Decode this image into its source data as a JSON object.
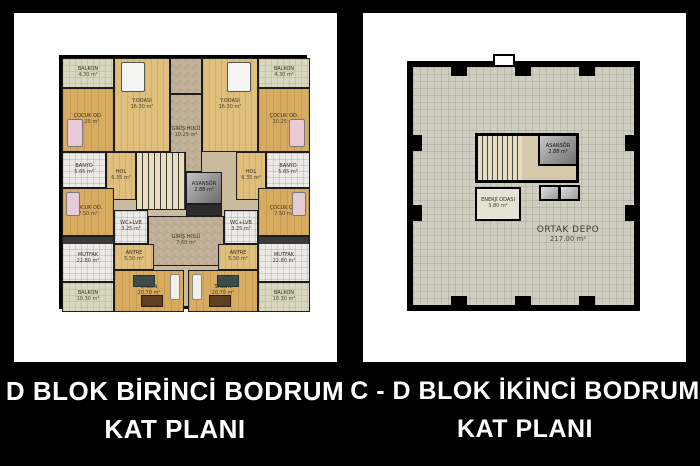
{
  "colors": {
    "background": "#000000",
    "panel": "#ffffff",
    "wood_floor": "#d7ab60",
    "hall_stone": "#c2b198",
    "balcony": "#d9d7bd",
    "depot_floor": "#cecdbf",
    "caption_text": "#ffffff"
  },
  "left_panel": {
    "caption_line1": "D BLOK BİRİNCİ BODRUM",
    "caption_line2": "KAT PLANI",
    "plan": {
      "rooms": {
        "balkon_ust": {
          "name": "BALKON",
          "area": "4.30 m²"
        },
        "cocuk_od_ust": {
          "name": "ÇOCUK OD.",
          "area": "10.25 m²"
        },
        "y_odasi": {
          "name": "Y.ODASI",
          "area": "16.30 m²"
        },
        "giris_holu_ust": {
          "name": "GİRİŞ HOLÜ",
          "area": "10.25 m²"
        },
        "banyo": {
          "name": "BANYO",
          "area": "5.65 m²"
        },
        "hol": {
          "name": "HOL",
          "area": "6.35 m²"
        },
        "asansor": {
          "name": "ASANSÖR",
          "area": "2.88 m²"
        },
        "cocuk_od_alt": {
          "name": "ÇOCUK OD.",
          "area": "7.50 m²"
        },
        "wc_lvb": {
          "name": "WC+LVB",
          "area": "3.25 m²"
        },
        "giris_holu_alt": {
          "name": "GİRİŞ HOLÜ",
          "area": "7.60 m²"
        },
        "antre": {
          "name": "ANTRE",
          "area": "5.50 m²"
        },
        "mutfak": {
          "name": "MUTFAK",
          "area": "22.80 m²"
        },
        "salon": {
          "name": "SALON",
          "area": "20.70 m²"
        },
        "balkon_alt": {
          "name": "BALKON",
          "area": "10.30 m²"
        }
      }
    }
  },
  "right_panel": {
    "caption_line1": "C - D BLOK İKİNCİ BODRUM",
    "caption_line2": "KAT PLANI",
    "plan": {
      "rooms": {
        "asansor": {
          "name": "ASANSÖR",
          "area": "2.88 m²"
        },
        "enerji_odasi": {
          "name": "ENERJİ ODASI",
          "area": "3.80 m²"
        },
        "ortak_depo": {
          "name": "ORTAK DEPO",
          "area": "217.00 m²"
        }
      }
    }
  }
}
